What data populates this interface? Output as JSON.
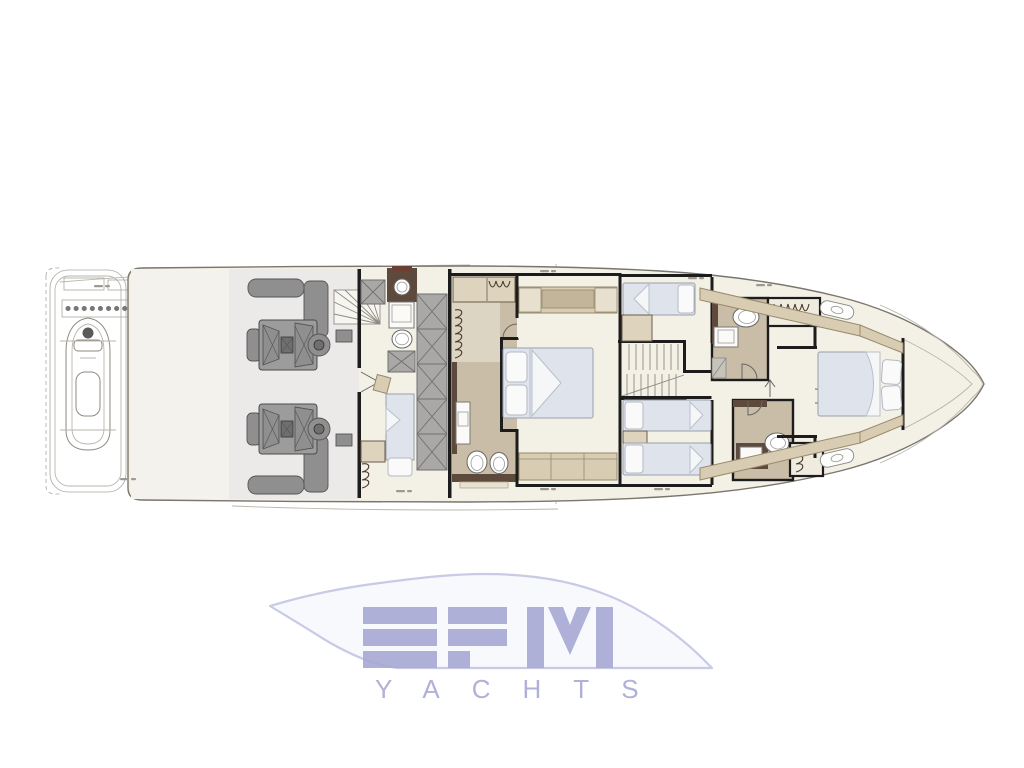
{
  "logo": {
    "brand": "EFM",
    "wordmark": "YACHTS",
    "aria": "EFM YACHTS logo"
  },
  "colors": {
    "wall": "#1c1c1c",
    "floor": "#f3f0e5",
    "garageFloor": "#f4f2ec",
    "engineFloor": "#ece9e9",
    "tanFloor": "#c9bda7",
    "tanFloorLight": "#ddd5c3",
    "furnitureTan": "#d8cdb2",
    "wardrobeTan": "#ded4bd",
    "brown": "#5e4a3c",
    "bed": "#dfe4ec",
    "pillow": "#fafafa",
    "hatch": "#aaa8a7",
    "engine": "#9c9c9c",
    "lineMid": "#8f8a82",
    "lineFaint": "#b9b6ae",
    "logoLetter": "#a7a9d5",
    "logoOutline": "#c8cae6",
    "logoFill": "#f8f9fd"
  }
}
